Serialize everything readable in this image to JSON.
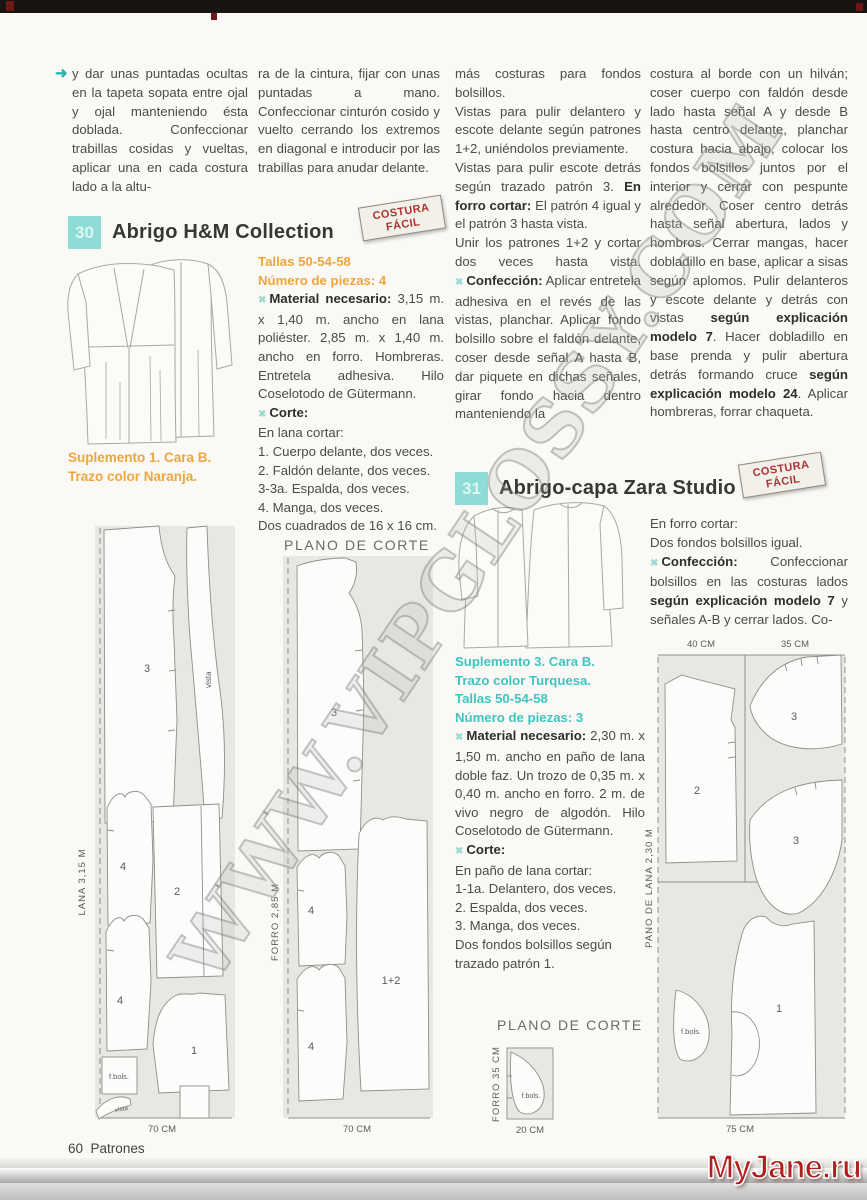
{
  "page": {
    "number": "60",
    "section": "Patrones",
    "watermark": "WWW.VIPGLOSSY.COM",
    "logo": "MyJane.ru"
  },
  "icons": {
    "bullet": "✖",
    "arrow": "➜"
  },
  "stamp": {
    "line1": "COSTURA",
    "line2": "FÁCIL"
  },
  "colors": {
    "accent_teal": "#8edcd6",
    "accent_orange": "#eda63f",
    "accent_turquoise": "#40c4c1",
    "stamp_red": "#ad3434",
    "logo_red": "#b21d1d"
  },
  "intro": {
    "col1": "y dar unas puntadas ocultas en la tapeta sopata entre ojal y ojal manteniendo ésta doblada. Confeccionar trabillas cosidas y vueltas, aplicar una en cada costura lado a la altu-",
    "col2": "ra de la cintura, fijar con unas puntadas a mano. Confeccionar cinturón cosido y vuelto cerrando los extremos en diagonal e introducir por las trabillas para anudar delante."
  },
  "m30": {
    "badge": "30",
    "title": "Abrigo H&M Collection",
    "tallas": "Tallas 50-54-58",
    "piezas": "Número de piezas: 4",
    "material_label": "Material necesario:",
    "material_text": " 3,15 m. x 1,40 m. ancho en lana poliéster. 2,85 m. x 1,40 m. ancho en forro. Hombreras. Entretela adhesiva. Hilo Coselotodo de Gütermann.",
    "corte_label": "Corte:",
    "corte_intro": "En lana cortar:",
    "corte_items": "1. Cuerpo delante, dos veces.\n2. Faldón delante, dos veces.\n3-3a. Espalda, dos veces.\n4. Manga, dos veces.\nDos cuadrados de 16 x 16 cm.",
    "suplemento": "Suplemento 1. Cara B.\nTrazo color Naranja.",
    "col3_p1": "más costuras para fondos bolsillos.\nVistas para pulir delantero y escote delante según patrones 1+2, uniéndolos previamente.\nVistas para pulir escote detrás según trazado patrón 3.",
    "col3_b1": "En forro cortar:",
    "col3_p2": "El patrón 4 igual y el patrón 3 hasta vista.\nUnir los patrones 1+2 y cortar dos veces hasta vista.",
    "conf_label": "Confección:",
    "col3_p3": " Aplicar entretela adhesiva en el revés de las vistas, planchar. Aplicar fondo bolsillo sobre el faldón delante, coser desde señal A hasta B, dar piquete en dichas señales, girar fondo hacia dentro manteniendo la",
    "col4_s1": "costura al borde con un hilván; coser cuerpo con faldón desde lado hasta señal A y desde B hasta centro delante, planchar costura hacia abajo, colocar los fondos bolsillos juntos por el interior y cerrar con pespunte alrededor. Coser centro detrás hasta señal abertura, lados y hombros. Cerrar mangas, hacer dobladillo en base, aplicar a sisas según aplomos. Pulir delanteros y escote delante y detrás con vistas ",
    "col4_b1": "según explicación modelo 7",
    "col4_s2": ". Hacer dobladillo en base prenda y pulir abertura detrás formando cruce ",
    "col4_b2": "según explicación modelo 24",
    "col4_s3": ". Aplicar hombreras, forrar chaqueta."
  },
  "m31": {
    "badge": "31",
    "title": "Abrigo-capa Zara Studio",
    "col4_l1": "En forro cortar:",
    "col4_l2": "Dos fondos bolsillos igual.",
    "conf_label": "Confección:",
    "col4_s1": " Confeccionar bolsillos en las costuras lados ",
    "col4_b1": "según explicación modelo 7",
    "col4_s2": " y señales A-B y cerrar lados. Co-",
    "suplemento": "Suplemento 3. Cara B.\nTrazo color Turquesa.\nTallas 50-54-58\nNúmero de piezas: 3",
    "material_label": "Material necesario:",
    "material_text": " 2,30 m. x 1,50 m. ancho en paño de lana doble faz. Un trozo de 0,35 m. x 0,40 m. ancho en forro. 2 m. de vivo negro de algodón. Hilo Coselotodo de Gütermann.",
    "corte_label": "Corte:",
    "corte_intro": "En paño de lana cortar:",
    "corte_items": "1-1a. Delantero, dos veces.\n2. Espalda, dos veces.\n3. Manga, dos veces.\nDos fondos bolsillos según trazado patrón 1."
  },
  "diagrams": {
    "heading1": "PLANO DE CORTE",
    "heading2": "PLANO DE CORTE",
    "lana": {
      "side": "LANA   3,15 M",
      "width": "70 CM",
      "p3": "3",
      "vista": "vista",
      "p4a": "4",
      "p2": "2",
      "p4b": "4",
      "p1": "1",
      "fbols": "f.bols.",
      "vista2": "vista"
    },
    "forro": {
      "side": "FORRO   2,85 M",
      "width": "70 CM",
      "p3": "3",
      "p4a": "4",
      "p12": "1+2",
      "p4b": "4"
    },
    "pano": {
      "side": "PAÑO DE LANA   2,30 M",
      "w40": "40 CM",
      "w35": "35 CM",
      "width": "75 CM",
      "p2": "2",
      "p3a": "3",
      "p3b": "3",
      "p1": "1",
      "fbols": "f.bols."
    },
    "forro2": {
      "side": "FORRO   35 CM",
      "width": "20 CM",
      "fbols": "f.bols."
    }
  }
}
